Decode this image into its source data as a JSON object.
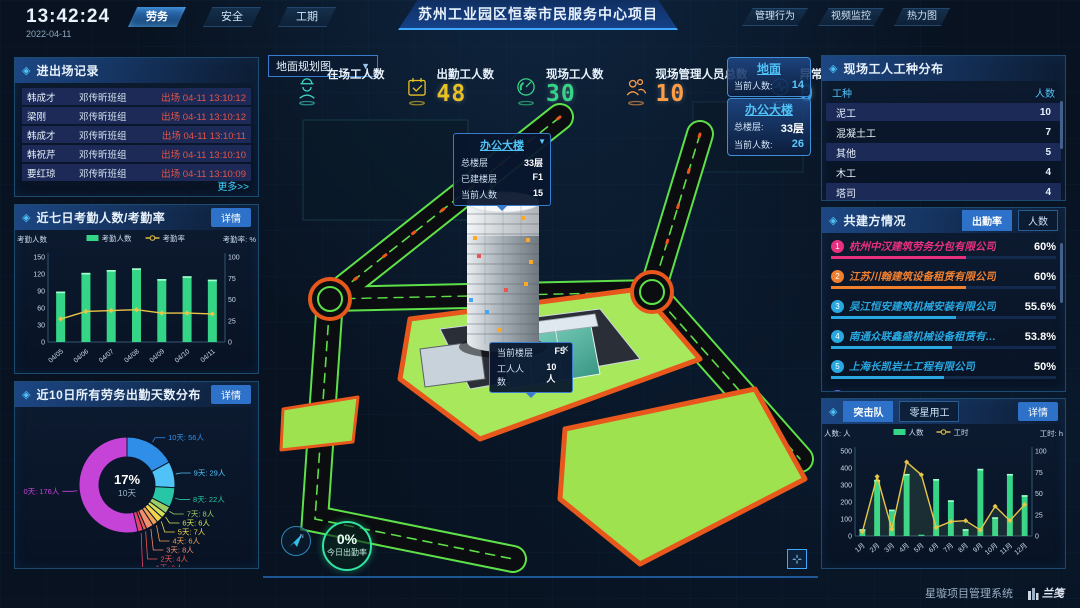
{
  "colors": {
    "accent_cyan": "#4fc3f7",
    "accent_blue": "#2d72c8",
    "bar_green": "#35d588",
    "line_yellow": "#e8c547",
    "alert_red": "#e25548",
    "lawn_green": "#9fe24f",
    "curb_orange": "#e8581c",
    "road_green": "#5ee048"
  },
  "topbar": {
    "time": "13:42:24",
    "date": "2022-04-11",
    "left_tabs": [
      {
        "label": "劳务",
        "active": true
      },
      {
        "label": "安全",
        "active": false
      },
      {
        "label": "工期",
        "active": false
      }
    ],
    "title": "苏州工业园区恒泰市民服务中心项目",
    "right_tabs": [
      {
        "label": "管理行为"
      },
      {
        "label": "视频监控"
      },
      {
        "label": "热力图"
      }
    ]
  },
  "entry_exit": {
    "title": "进出场记录",
    "more_label": "更多>>",
    "rows": [
      {
        "name": "韩成才",
        "team": "邓传昕班组",
        "event": "出场 04-11 13:10:12"
      },
      {
        "name": "梁刚",
        "team": "邓传昕班组",
        "event": "出场 04-11 13:10:12"
      },
      {
        "name": "韩成才",
        "team": "邓传昕班组",
        "event": "出场 04-11 13:10:11"
      },
      {
        "name": "韩祝芹",
        "team": "邓传昕班组",
        "event": "出场 04-11 13:10:10"
      },
      {
        "name": "要红琼",
        "team": "邓传昕班组",
        "event": "出场 04-11 13:10:09"
      }
    ]
  },
  "attendance_panel": {
    "title": "近七日考勤人数/考勤率",
    "detail_label": "详情"
  },
  "distribution_panel": {
    "title": "近10日所有劳务出勤天数分布",
    "detail_label": "详情"
  },
  "worker_types": {
    "title": "现场工人工种分布",
    "headers": [
      "工种",
      "人数"
    ],
    "rows": [
      {
        "type": "泥工",
        "count": "10"
      },
      {
        "type": "混凝土工",
        "count": "7"
      },
      {
        "type": "其他",
        "count": "5"
      },
      {
        "type": "木工",
        "count": "4"
      },
      {
        "type": "塔司",
        "count": "4"
      }
    ]
  },
  "partners": {
    "title": "共建方情况",
    "tabs": [
      {
        "label": "出勤率",
        "active": true
      },
      {
        "label": "人数",
        "active": false
      }
    ],
    "items": [
      {
        "rank": "1",
        "name": "杭州中汉建筑劳务分包有限公司",
        "pct": "60%",
        "value": 60,
        "color": "#e8317e"
      },
      {
        "rank": "2",
        "name": "江苏川翰建筑设备租赁有限公司",
        "pct": "60%",
        "value": 60,
        "color": "#f07f2e"
      },
      {
        "rank": "3",
        "name": "吴江恒安建筑机械安装有限公司",
        "pct": "55.6%",
        "value": 55.6,
        "color": "#29a7e0"
      },
      {
        "rank": "4",
        "name": "南通众联鑫盛机械设备租赁有限公司",
        "pct": "53.8%",
        "value": 53.8,
        "color": "#29a7e0"
      },
      {
        "rank": "5",
        "name": "上海长凯岩土工程有限公司",
        "pct": "50%",
        "value": 50,
        "color": "#29a7e0"
      },
      {
        "rank": "6",
        "name": "江苏洁治建筑安装工程有限公司",
        "pct": "35.4%",
        "value": 35.4,
        "color": "#8a5cf5"
      }
    ]
  },
  "squad_panel": {
    "tabs": [
      {
        "label": "突击队",
        "active": true
      },
      {
        "label": "零星用工",
        "active": false
      }
    ],
    "detail_label": "详情"
  },
  "stats": [
    {
      "label": "在场工人数",
      "value": "",
      "color": "#3bd6c6"
    },
    {
      "label": "出勤工人数",
      "value": "48",
      "color": "#e8c125"
    },
    {
      "label": "现场工人数",
      "value": "30",
      "color": "#35d588"
    },
    {
      "label": "现场管理人员总数",
      "value": "10",
      "color": "#ff9d45"
    },
    {
      "label": "异常出勤数",
      "value": "0",
      "color": "#35a0e8"
    }
  ],
  "map": {
    "layer_select": "地面规划图",
    "building_tooltip": {
      "title": "办公大楼",
      "rows": [
        [
          "总楼层",
          "33层"
        ],
        [
          "已建楼层",
          "F1"
        ],
        [
          "当前人数",
          "15"
        ]
      ]
    },
    "floor_tooltip": {
      "rows": [
        [
          "当前楼层",
          "F5"
        ],
        [
          "工人人数",
          "10人"
        ]
      ]
    },
    "info_boxes": [
      {
        "title": "地面",
        "rows": [
          [
            "当前人数:",
            "14"
          ]
        ]
      },
      {
        "title": "办公大楼",
        "rows": [
          [
            "总楼层:",
            "33层"
          ],
          [
            "当前人数:",
            "26"
          ]
        ]
      }
    ],
    "attendance_circle": {
      "pct": "0%",
      "label": "今日出勤率"
    }
  },
  "footer": {
    "system_name": "星璇项目管理系统",
    "logo_text": "兰笺"
  },
  "chart_data": [
    {
      "id": "attendance7",
      "type": "bar+line",
      "title": "近七日考勤人数/考勤率",
      "categories": [
        "04/05",
        "04/06",
        "04/07",
        "04/08",
        "04/09",
        "04/10",
        "04/11"
      ],
      "series": [
        {
          "name": "考勤人数",
          "type": "bar",
          "axis": "left",
          "color": "#35d588",
          "values": [
            89,
            122,
            127,
            130,
            111,
            116,
            110
          ]
        },
        {
          "name": "考勤率",
          "type": "line",
          "axis": "right",
          "color": "#e8c547",
          "values": [
            27,
            36,
            37,
            38,
            34,
            34,
            33
          ]
        }
      ],
      "left_axis": {
        "label": "考勤人数",
        "min": 0,
        "max": 150,
        "ticks": [
          0,
          30,
          60,
          90,
          120,
          150
        ]
      },
      "right_axis": {
        "label": "考勤率: %",
        "min": 0,
        "max": 100,
        "ticks": [
          0,
          25,
          50,
          75,
          100
        ]
      },
      "legend_position": "top"
    },
    {
      "id": "attendance_days",
      "type": "donut",
      "title": "近10日所有劳务出勤天数分布",
      "center": {
        "pct": "17%",
        "label": "10天"
      },
      "slices": [
        {
          "label": "10天",
          "count": "56人",
          "value": 56,
          "color": "#2f8fe8"
        },
        {
          "label": "9天",
          "count": "29人",
          "value": 29,
          "color": "#4fc3f7"
        },
        {
          "label": "8天",
          "count": "22人",
          "value": 22,
          "color": "#26c6a6"
        },
        {
          "label": "7天",
          "count": "8人",
          "value": 8,
          "color": "#9ccc65"
        },
        {
          "label": "6天",
          "count": "6人",
          "value": 6,
          "color": "#d4e157"
        },
        {
          "label": "5天",
          "count": "7人",
          "value": 7,
          "color": "#f2d54e"
        },
        {
          "label": "4天",
          "count": "6人",
          "value": 6,
          "color": "#f2a154"
        },
        {
          "label": "3天",
          "count": "8人",
          "value": 8,
          "color": "#f28c6c"
        },
        {
          "label": "2天",
          "count": "4人",
          "value": 4,
          "color": "#e85a50"
        },
        {
          "label": "1天",
          "count": "6人",
          "value": 6,
          "color": "#e8436a"
        },
        {
          "label": "0天",
          "count": "176人",
          "value": 176,
          "color": "#c643d8"
        }
      ]
    },
    {
      "id": "squad_monthly",
      "type": "bar+line",
      "title": "突击队",
      "categories": [
        "1月",
        "2月",
        "3月",
        "4月",
        "5月",
        "6月",
        "7月",
        "8月",
        "9月",
        "10月",
        "11月",
        "12月"
      ],
      "series": [
        {
          "name": "人数",
          "type": "bar",
          "axis": "left",
          "color": "#35d588",
          "values": [
            40,
            330,
            155,
            365,
            8,
            335,
            210,
            40,
            395,
            110,
            365,
            240
          ]
        },
        {
          "name": "工时",
          "type": "line",
          "axis": "right",
          "color": "#e8c547",
          "area": true,
          "values": [
            5,
            70,
            8,
            87,
            72,
            10,
            17,
            18,
            7,
            35,
            18,
            37
          ]
        }
      ],
      "left_axis": {
        "label": "人数: 人",
        "min": 0,
        "max": 500,
        "ticks": [
          0,
          100,
          200,
          300,
          400,
          500
        ]
      },
      "right_axis": {
        "label": "工时: h",
        "min": 0,
        "max": 100,
        "ticks": [
          0,
          25,
          50,
          75,
          100
        ]
      },
      "legend_position": "top"
    }
  ]
}
